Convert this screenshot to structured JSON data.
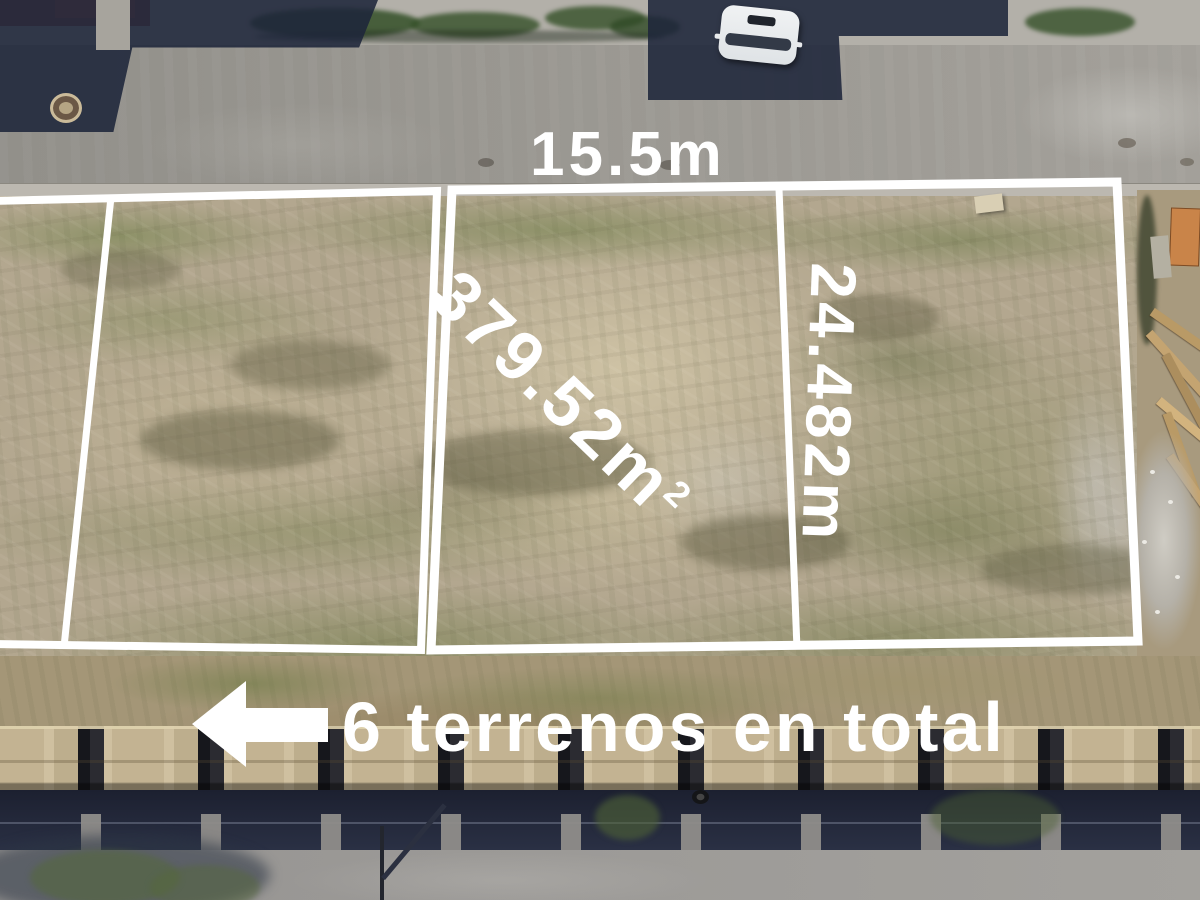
{
  "annotations": {
    "front_width_label": "15.5m",
    "area_label_value": "379.52m",
    "area_label_sup": "2",
    "depth_label": "24.482m",
    "total_lots_label": "6 terrenos en total"
  },
  "colors": {
    "overlay_white": "#ffffff",
    "road_gray": "#9a9894",
    "land_tan": "#b3a78f",
    "building_shadow_navy": "#273046",
    "wall_concrete_tan": "#cdbd9d",
    "grass_green": "#7c8a5c"
  }
}
